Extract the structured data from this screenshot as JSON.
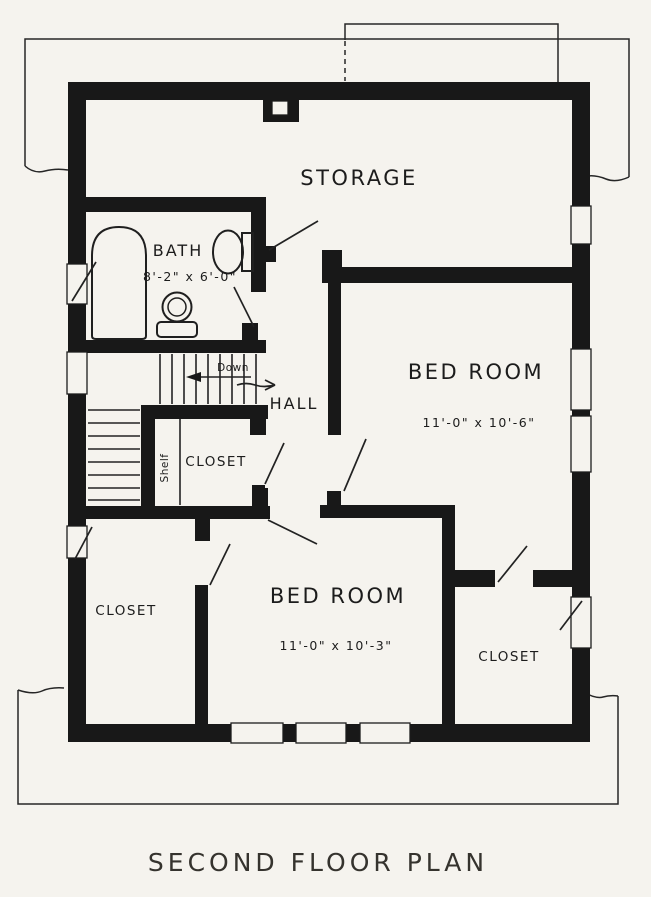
{
  "plan": {
    "caption": "SECOND FLOOR PLAN",
    "rooms": {
      "storage": {
        "label": "STORAGE"
      },
      "bath": {
        "label": "BATH",
        "dims": "8'-2\" x 6'-0\""
      },
      "bedroom_right": {
        "label": "BED ROOM",
        "dims": "11'-0\" x 10'-6\""
      },
      "bedroom_bottom": {
        "label": "BED ROOM",
        "dims": "11'-0\" x 10'-3\""
      },
      "hall": {
        "label": "HALL"
      },
      "closet_center": {
        "label": "CLOSET"
      },
      "closet_left": {
        "label": "CLOSET"
      },
      "closet_right": {
        "label": "CLOSET"
      }
    },
    "stairs": {
      "down_label": "Down",
      "shelf_label": "Shelf"
    },
    "colors": {
      "ink": "#181818",
      "paper": "#f5f3ee",
      "outline": "#262626"
    }
  }
}
